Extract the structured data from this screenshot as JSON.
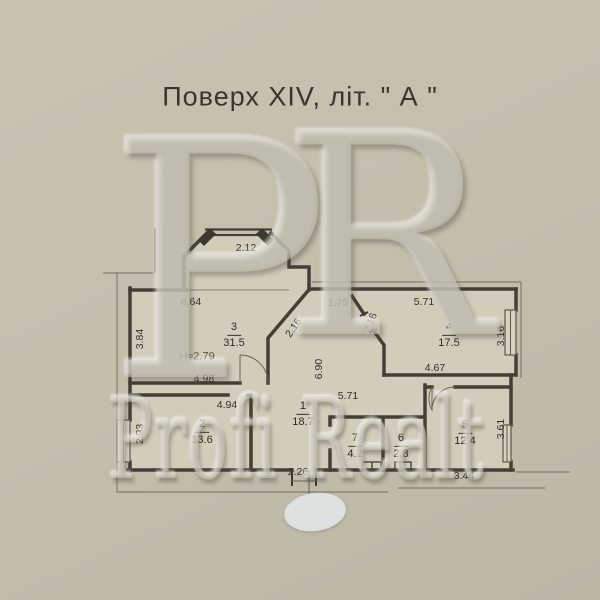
{
  "title": "Поверх XIV, літ. \" А \"",
  "height_note": "H≈2.79",
  "rooms": {
    "r1": {
      "number": "1",
      "area": "18.7"
    },
    "r2": {
      "number": "2",
      "area": "13.6"
    },
    "r3": {
      "number": "3",
      "area": "31.5"
    },
    "r4": {
      "number": "4",
      "area": "17.5"
    },
    "r5": {
      "number": "5",
      "area": "12.4"
    },
    "r6": {
      "number": "6",
      "area": "2.8"
    },
    "r7": {
      "number": "7",
      "area": "4.2"
    }
  },
  "dims": {
    "bay_top": "2.12",
    "room3_top": "6.64",
    "room3_left": "3.84",
    "room3_bottom": "4.98",
    "room2_top": "4.94",
    "room2_left": "2.93",
    "corridor_top": "1.75",
    "chamfer_left": "2.16",
    "chamfer_right": "2.16",
    "room4_top": "5.71",
    "room4_right": "3.16",
    "room4_bottom": "4.67",
    "hall_vertical": "6.90",
    "hall_bottom": "5.71",
    "entrance_width": "2.26",
    "room5_bottom": "3.44",
    "room5_right": "3.61"
  },
  "watermark": {
    "letter_p": "P",
    "letter_r": "R",
    "brand": "Profi Realt"
  },
  "colors": {
    "background": "#c2bcab",
    "paper": "#d1cbba",
    "wall": "#443f36",
    "text": "#33302a",
    "redaction": "#dfe5e3"
  }
}
